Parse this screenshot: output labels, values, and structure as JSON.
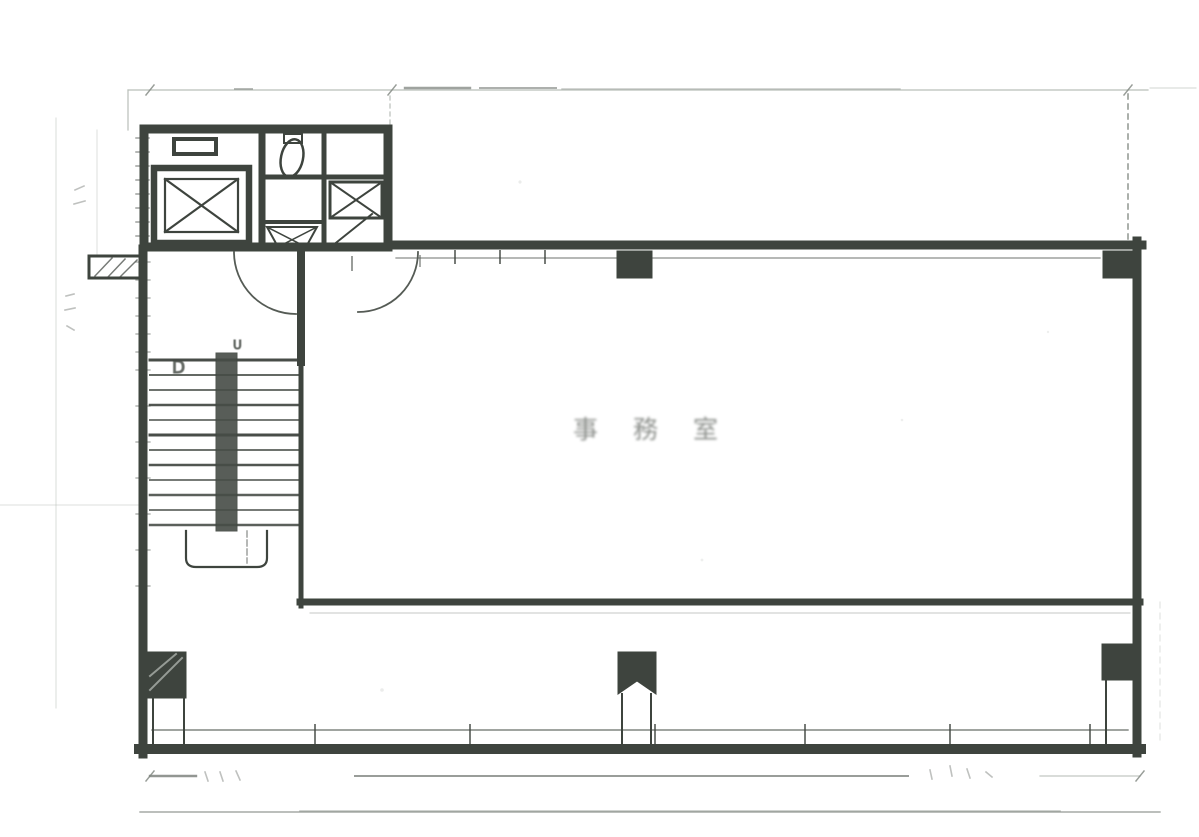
{
  "document": {
    "kind": "scanned architectural floor plan (black and white photocopy)",
    "page_background": "#ffffff"
  },
  "colors": {
    "ink": "#3f453f",
    "faint_line": "#b8beb8",
    "dimension_line": "#8f958f",
    "label_text": "#70746f"
  },
  "labels": {
    "office_room": "事務室",
    "stair_down": "D",
    "stair_up": "U"
  },
  "symbols": [
    "elevator-shaft-x-icon",
    "elevator-door-icon",
    "toilet-fixture-icon",
    "wash-basin-icon",
    "shaft-x-box-icon",
    "door-swing-arc-icon",
    "stair-run-with-return-icon",
    "structural-column-icon",
    "window-mullion-band-icon",
    "dimension-line-icon"
  ]
}
